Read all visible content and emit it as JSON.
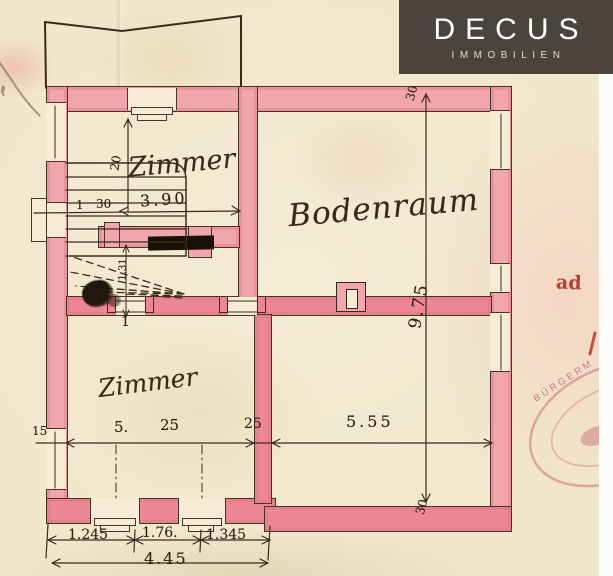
{
  "logo": {
    "name": "DECUS",
    "subtitle": "IMMOBILIEN"
  },
  "rooms": {
    "zimmer_top": "Zimmer",
    "bodenraum": "Bodenraum",
    "zimmer_bottom": "Zimmer"
  },
  "dims": {
    "room_top_width": "3.90",
    "window_offset": "20",
    "stair_width": "1",
    "wall_30_left": "30",
    "landing_depth": "1.31",
    "door_mark": "1",
    "bodenraum_depth": "9.75",
    "wall_30_top": "30",
    "wall_30_bottom": "30",
    "room_bottom_width_a": "5.",
    "room_bottom_width_b": "25",
    "wall_25": "25",
    "left_mark_15": "15",
    "right_span": "5.55",
    "win_a": "1.245",
    "win_b": "1.76.",
    "win_c": "1.345",
    "total": "4.45"
  },
  "notes": {
    "ad": "ad"
  },
  "stamp": {
    "arc_text": "BÜRGERM"
  },
  "colors": {
    "wall_pink": "#f1a6ae",
    "wall_bright": "#ee8795",
    "ink": "#3a2c1c",
    "paper": "#f2e9cf",
    "logo_bg": "#4b443d",
    "red_note": "#c23b31",
    "stamp_red": "#c96a78"
  }
}
